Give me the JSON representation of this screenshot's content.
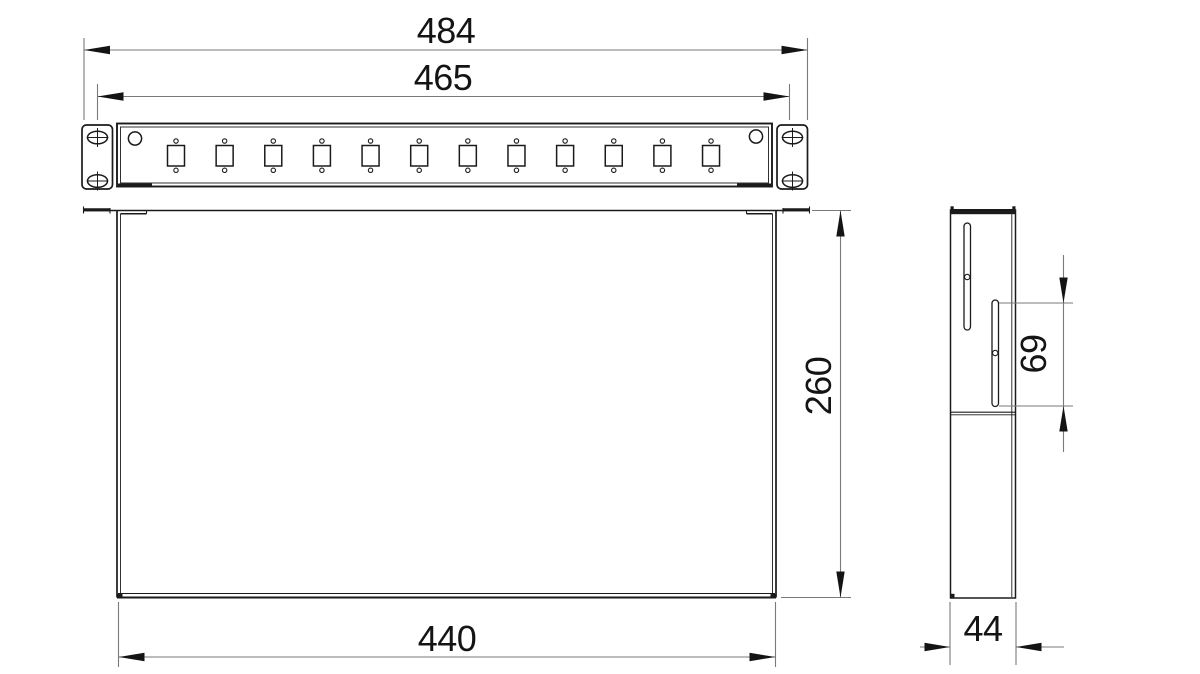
{
  "drawing": {
    "background": "#ffffff",
    "object_line_color": "#1b1b1b",
    "dimension_line_color": "#7a7a7a",
    "dimension_text_color": "#141414",
    "dimensions": {
      "overall_width": "484",
      "mounting_width": "465",
      "depth": "260",
      "body_width": "440",
      "side_width": "44",
      "slot_length": "69"
    },
    "front_view": {
      "adapter_count": 12,
      "ear_hole_count_per_ear": 2,
      "pilot_hole_count": 2
    },
    "side_view": {
      "slot_count": 2
    }
  }
}
